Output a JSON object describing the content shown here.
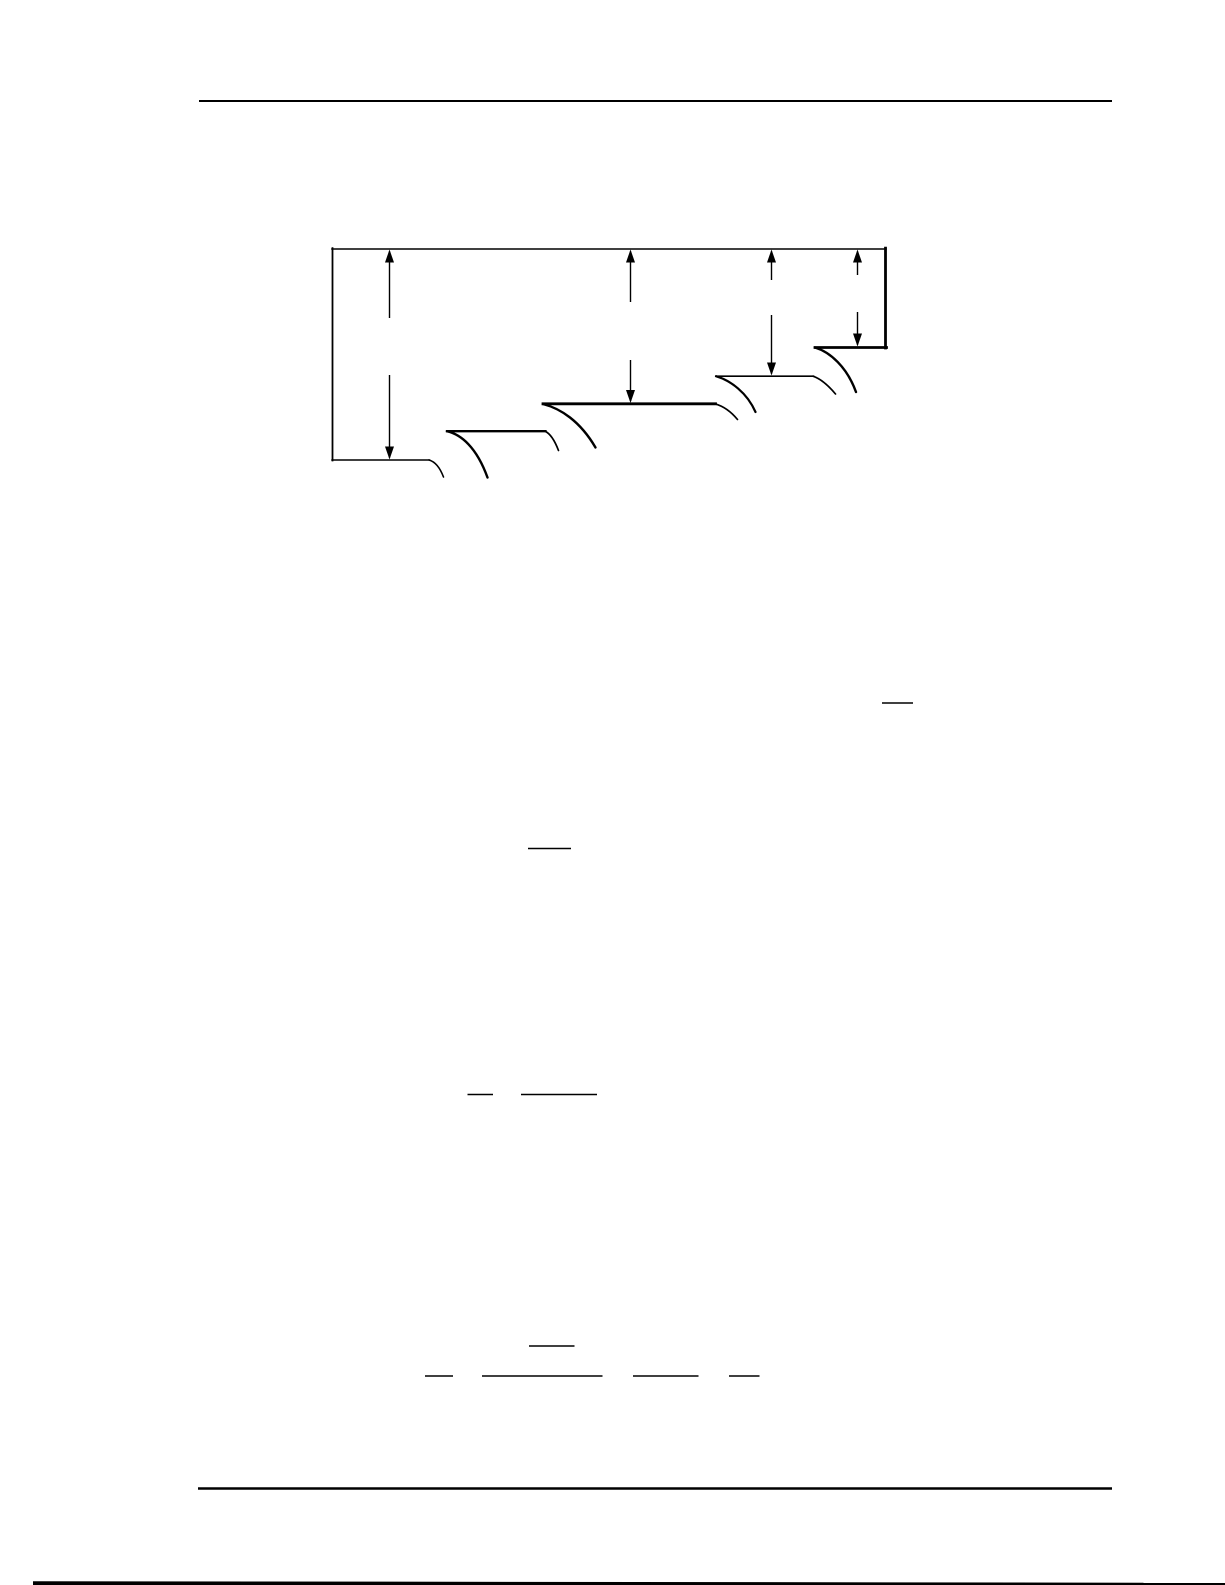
{
  "page": {
    "width": 1225,
    "height": 1585,
    "background": "#ffffff",
    "ink": "#000000"
  },
  "rules": {
    "header": {
      "name": "header-rule",
      "x1": 199,
      "x2": 1112,
      "y": 101,
      "weight": 2
    },
    "footer": {
      "name": "footer-rule",
      "x1": 198,
      "x2": 1112,
      "y": 1488.5,
      "weight": 2.6
    }
  },
  "figure": {
    "name": "stepped-cascade-profile-figure",
    "lines": [
      {
        "name": "reference-water-level",
        "x1": 332,
        "y1": 249,
        "x2": 886,
        "y2": 249,
        "weight": 1.6
      },
      {
        "name": "left-wall",
        "x1": 332.5,
        "y1": 248.2,
        "x2": 332.5,
        "y2": 460.5,
        "weight": 1.8
      },
      {
        "name": "right-wall",
        "x1": 885.5,
        "y1": 248.2,
        "x2": 885.5,
        "y2": 348,
        "weight": 2.8
      },
      {
        "name": "pool-level-5",
        "x1": 815,
        "y1": 347.5,
        "x2": 886.5,
        "y2": 347.5,
        "weight": 2.8
      },
      {
        "name": "pool-level-4",
        "x1": 716,
        "y1": 376.2,
        "x2": 813.5,
        "y2": 376.2,
        "weight": 1.6
      },
      {
        "name": "pool-level-3",
        "x1": 543,
        "y1": 403.8,
        "x2": 715.5,
        "y2": 403.8,
        "weight": 2.8
      },
      {
        "name": "pool-level-2",
        "x1": 447,
        "y1": 431.2,
        "x2": 545.5,
        "y2": 431.2,
        "weight": 2.3
      },
      {
        "name": "pool-level-1",
        "x1": 332,
        "y1": 460,
        "x2": 429.5,
        "y2": 460,
        "weight": 1.5
      }
    ],
    "curves": [
      {
        "name": "pool1-brink-drawdown",
        "path": "M 429,460 C 434.5,461.5 439.5,466.5 443.5,477",
        "weight": 1.6
      },
      {
        "name": "nappe-from-pool2",
        "path": "M 447,431.2 C 461,434.5 476.5,447 487.5,477.5",
        "weight": 2.4
      },
      {
        "name": "pool2-brink-drawdown",
        "path": "M 545,431.2 C 550,433.5 554.5,440 558.5,450.5",
        "weight": 1.7
      },
      {
        "name": "nappe-from-pool3",
        "path": "M 543,404 C 560.5,408.5 580,421 595.5,447.5",
        "weight": 2.4
      },
      {
        "name": "pool3-brink-drawdown",
        "path": "M 715,403.8 C 722,405.8 730.5,411 737.5,419.5",
        "weight": 1.7
      },
      {
        "name": "nappe-from-pool4",
        "path": "M 716,376.2 C 730.5,380.5 747,392.5 755.5,412",
        "weight": 2.2
      },
      {
        "name": "pool4-brink-drawdown",
        "path": "M 813,376.2 C 820,378.6 828,385 835.5,394",
        "weight": 1.7
      },
      {
        "name": "nappe-from-pool5",
        "path": "M 815,347.5 C 830,352 847,367 856,392",
        "weight": 2.4
      }
    ],
    "arrowhead": {
      "width": 9,
      "length": 13
    },
    "arrows": [
      {
        "name": "depth-arrow-1",
        "x": 389.5,
        "tip_top": 249.5,
        "break_top": 318,
        "break_bottom": 375,
        "tip_bottom": 459.5,
        "weight": 1.4
      },
      {
        "name": "depth-arrow-2",
        "x": 630.5,
        "tip_top": 249.5,
        "break_top": 302,
        "break_bottom": 360,
        "tip_bottom": 403,
        "weight": 1.4
      },
      {
        "name": "depth-arrow-3",
        "x": 771.5,
        "tip_top": 249.5,
        "break_top": 280,
        "break_bottom": 315,
        "tip_bottom": 375.5,
        "weight": 1.4
      },
      {
        "name": "depth-arrow-4",
        "x": 857.5,
        "tip_top": 249.5,
        "break_top": 275,
        "break_bottom": 312,
        "tip_bottom": 346.5,
        "weight": 1.4
      }
    ]
  },
  "equation_marks": [
    {
      "name": "fraction-bar-1",
      "x1": 882,
      "x2": 913,
      "y": 703,
      "weight": 1.5
    },
    {
      "name": "fraction-bar-2",
      "x1": 528,
      "x2": 571,
      "y": 848.5,
      "weight": 1.6
    },
    {
      "name": "fraction-bar-3a",
      "x1": 467.5,
      "x2": 493,
      "y": 1094.5,
      "weight": 1.5
    },
    {
      "name": "fraction-bar-3b",
      "x1": 521,
      "x2": 597,
      "y": 1094.5,
      "weight": 1.5
    },
    {
      "name": "fraction-bar-4",
      "x1": 529,
      "x2": 574.5,
      "y": 1346,
      "weight": 1.5
    },
    {
      "name": "fraction-bar-5a",
      "x1": 425,
      "x2": 453,
      "y": 1376,
      "weight": 1.5
    },
    {
      "name": "fraction-bar-5b",
      "x1": 482,
      "x2": 602.5,
      "y": 1376,
      "weight": 1.5
    },
    {
      "name": "fraction-bar-5c",
      "x1": 633,
      "x2": 698.5,
      "y": 1376,
      "weight": 1.5
    },
    {
      "name": "fraction-bar-5d",
      "x1": 729,
      "x2": 759.5,
      "y": 1376,
      "weight": 1.5
    }
  ],
  "page_edge": {
    "name": "page-bottom-edge-shadow",
    "points": "33,1581.2 1225,1582.8 1225,1585 33,1585"
  }
}
